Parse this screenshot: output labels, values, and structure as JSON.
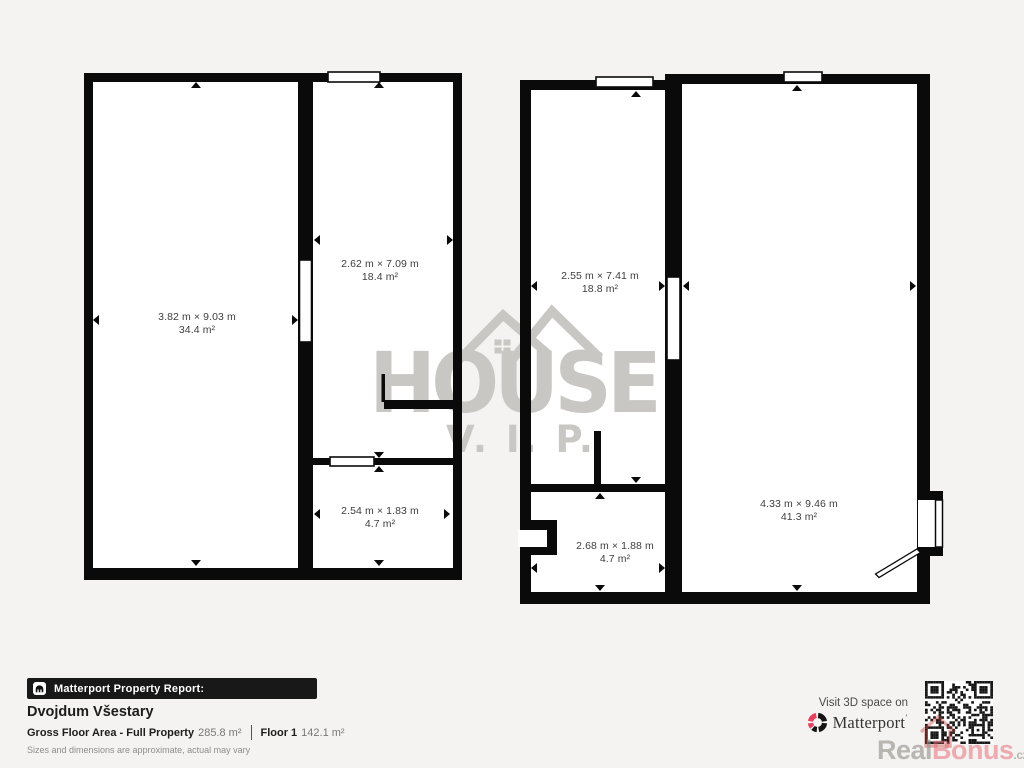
{
  "meta": {
    "colors": {
      "background": "#f4f3f1",
      "wall": "#0a0a0a",
      "watermark_gray": "#c9c7c4",
      "accent_red": "#e8415e"
    }
  },
  "watermark": {
    "line1": "HOUSE",
    "line2": "V. I. P."
  },
  "floorplan": {
    "rooms": [
      {
        "id": "left-building-large",
        "dims": "3.82 m × 9.03 m",
        "area": "34.4 m²"
      },
      {
        "id": "left-building-middle",
        "dims": "2.62 m × 7.09 m",
        "area": "18.4 m²"
      },
      {
        "id": "left-building-small",
        "dims": "2.54 m × 1.83 m",
        "area": "4.7 m²"
      },
      {
        "id": "right-building-left",
        "dims": "2.55 m × 7.41 m",
        "area": "18.8 m²"
      },
      {
        "id": "right-building-small",
        "dims": "2.68 m × 1.88 m",
        "area": "4.7 m²"
      },
      {
        "id": "right-building-large",
        "dims": "4.33 m × 9.46 m",
        "area": "41.3 m²"
      }
    ]
  },
  "footer": {
    "badge_label": "Matterport Property Report:",
    "property_name": "Dvojdum Všestary",
    "gfa_label": "Gross Floor Area - Full Property",
    "gfa_value": "285.8 m²",
    "floor_label": "Floor 1",
    "floor_value": "142.1 m²",
    "disclaimer": "Sizes and dimensions are approximate, actual may vary"
  },
  "branding": {
    "visit_text": "Visit 3D space on",
    "logo_text": "Matterport",
    "logo_tm": "’",
    "watermark_real": "Real",
    "watermark_bonus": "Bonus",
    "watermark_tld": ".cz"
  }
}
